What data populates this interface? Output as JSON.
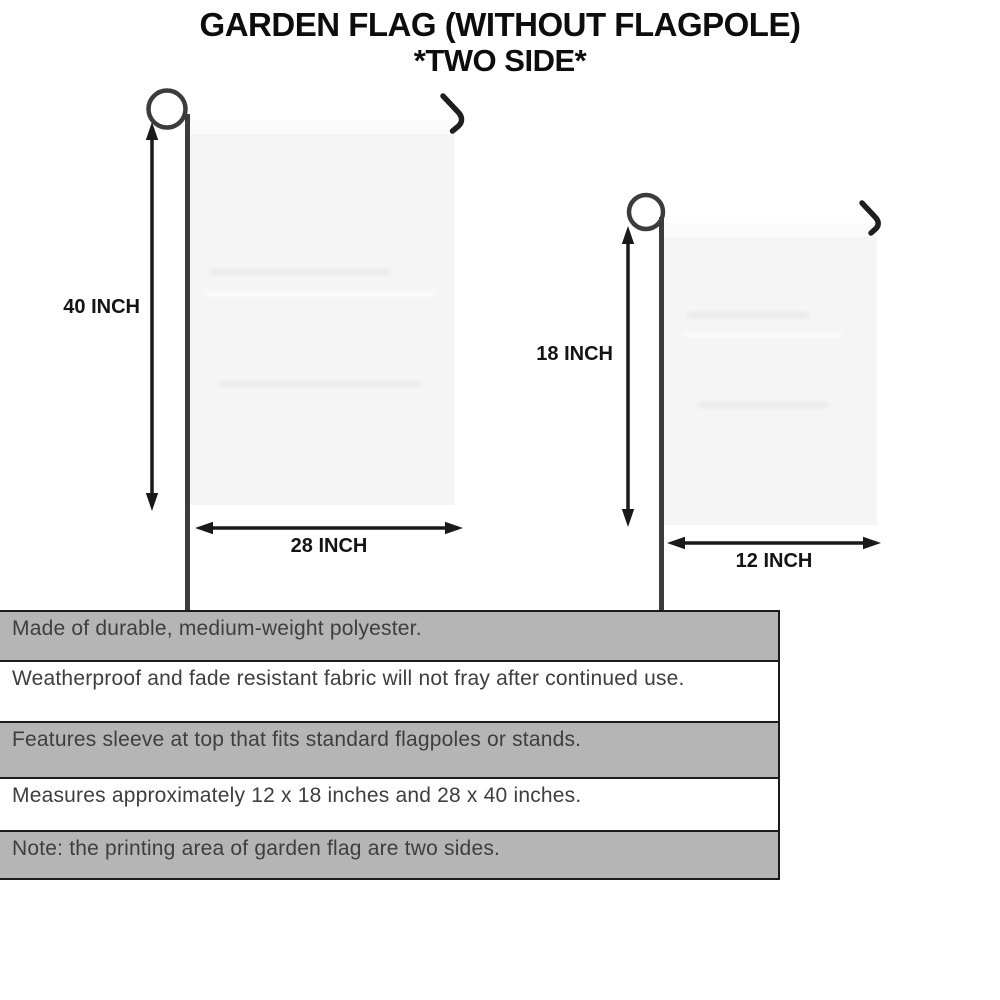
{
  "title": {
    "line1": "GARDEN FLAG (WITHOUT FLAGPOLE)",
    "line2": "*TWO SIDE*"
  },
  "flags": {
    "large": {
      "height_label": "40 INCH",
      "width_label": "28 INCH"
    },
    "small": {
      "height_label": "18 INCH",
      "width_label": "12 INCH"
    }
  },
  "features": [
    {
      "text": "Made of durable, medium-weight polyester.",
      "shaded": true
    },
    {
      "text": "Weatherproof and fade resistant fabric will not fray after continued use.",
      "shaded": false
    },
    {
      "text": "Features sleeve at top that fits standard flagpoles or stands.",
      "shaded": true
    },
    {
      "text": "Measures approximately 12 x 18 inches and 28 x 40 inches.",
      "shaded": false
    },
    {
      "text": "Note: the printing area of garden flag are two sides.",
      "shaded": true
    }
  ],
  "colors": {
    "flag_fill": "#f5f5f6",
    "pole": "#3c3c3a",
    "hook": "#1f1f1f",
    "arrow": "#1a1a1a",
    "table_gray": "#b5b5b5",
    "table_border": "#1c1c1c",
    "feature_text": "#3e3e3e"
  }
}
